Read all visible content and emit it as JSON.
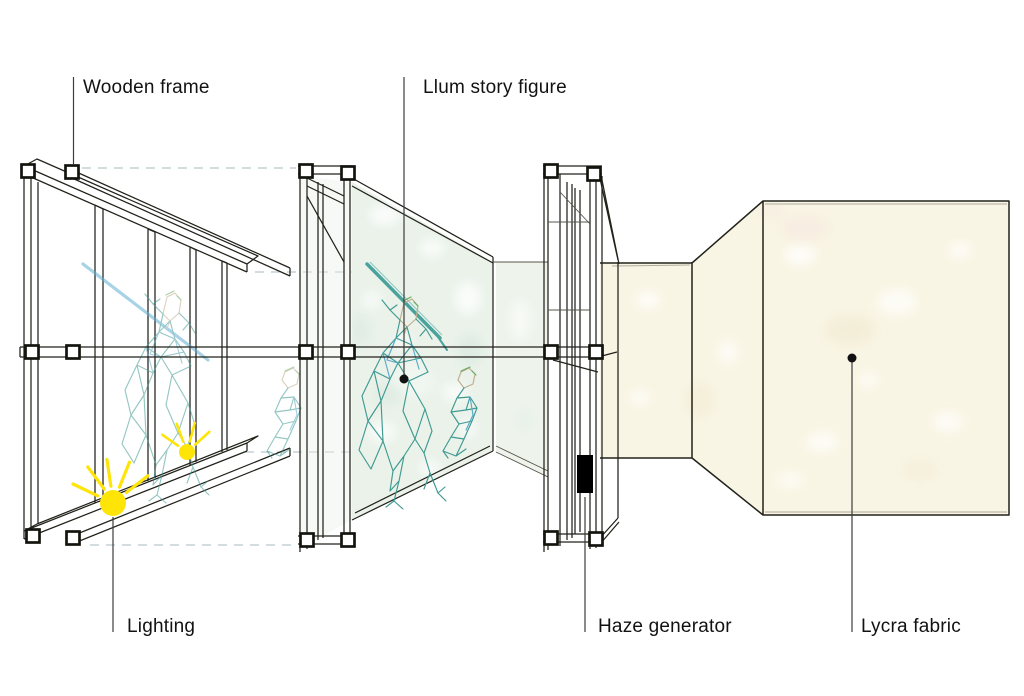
{
  "diagram": {
    "type": "exploded-installation-diagram",
    "labels": {
      "wooden_frame": "Wooden frame",
      "llum_story_figure": "Llum story figure",
      "lighting": "Lighting",
      "haze_generator": "Haze generator",
      "lycra_fabric": "Lycra fabric"
    },
    "icons": {
      "sun_large": "lighting-sun-icon",
      "sun_small": "lighting-sun-small-icon",
      "callout_dots": "callout-dot"
    },
    "colors": {
      "background": "#ffffff",
      "line": "#22221b",
      "leader_line": "#3c3c3c",
      "dashed_guide": "#b9c8c9",
      "scrim_fill": "#eaf2ea",
      "scrim_side_fill": "#eef4ec",
      "fabric_fill": "#f9f5e4",
      "figure_teal": "#3f9a92",
      "figure_blue": "#5ba9c9",
      "figure_head_tan": "#bfae8e",
      "figure_head_green": "#69a861",
      "staff_blue": "#62aed2",
      "sun_yellow": "#ffe408",
      "haze_box": "#000000"
    }
  }
}
